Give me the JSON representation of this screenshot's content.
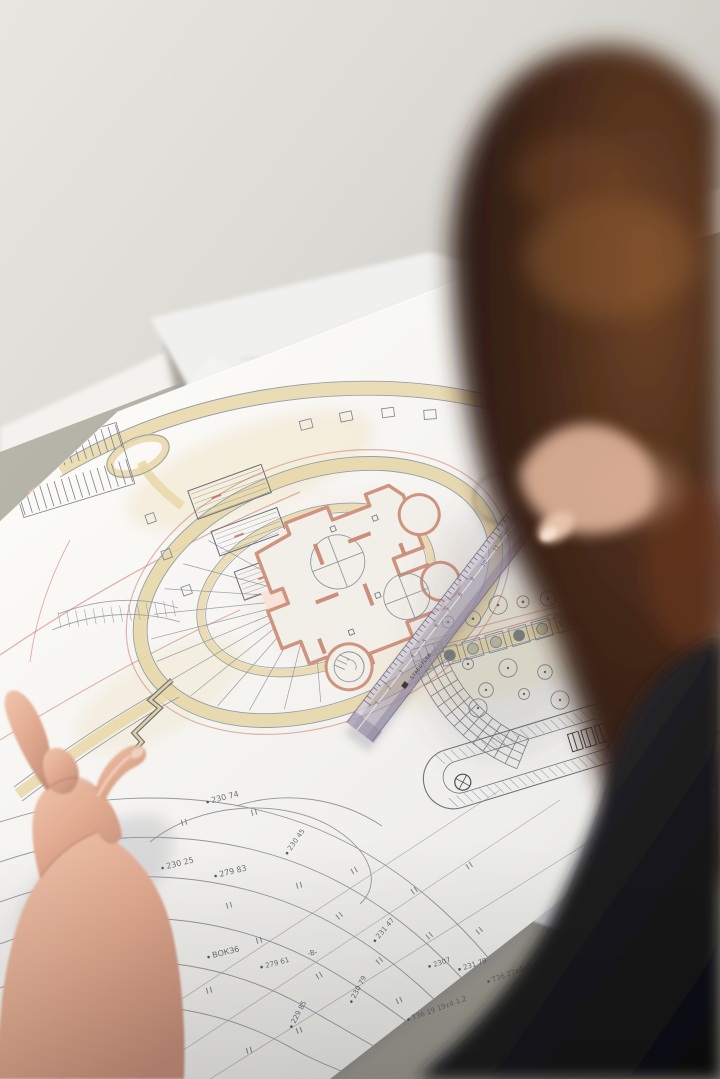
{
  "scene": {
    "description": "Over-the-shoulder photo of a person with curly auburn hair studying hand-drawn architectural master-plan and topographic sheets on a desk, left hand touching the plan, transparent ruler lying across the drawing",
    "ruler": {
      "brand": "STAEDTLER",
      "numbers": [
        "1",
        "2",
        "3",
        "4",
        "5",
        "6",
        "7",
        "8",
        "9",
        "10",
        "11",
        "12",
        "13",
        "14",
        "15",
        "16"
      ]
    },
    "plan": {
      "labels": [
        {
          "text": "230 74",
          "x": 212,
          "y": 803,
          "r": -14,
          "s": 8
        },
        {
          "text": "230 25",
          "x": 167,
          "y": 869,
          "r": -14,
          "s": 8
        },
        {
          "text": "279 83",
          "x": 220,
          "y": 877,
          "r": -14,
          "s": 8
        },
        {
          "text": "230 45",
          "x": 291,
          "y": 851,
          "r": -55,
          "s": 7
        },
        {
          "text": "ВОКЗ6",
          "x": 213,
          "y": 958,
          "r": -14,
          "s": 8
        },
        {
          "text": "229 85",
          "x": 295,
          "y": 1024,
          "r": -62,
          "s": 7
        },
        {
          "text": "230 79",
          "x": 355,
          "y": 999,
          "r": -62,
          "s": 7
        },
        {
          "text": "-В-",
          "x": 308,
          "y": 956,
          "r": -12,
          "s": 7
        },
        {
          "text": "279 61",
          "x": 266,
          "y": 968,
          "r": -15,
          "s": 7
        },
        {
          "text": "231 47",
          "x": 379,
          "y": 939,
          "r": -50,
          "s": 7
        },
        {
          "text": "2307",
          "x": 434,
          "y": 967,
          "r": -18,
          "s": 7
        },
        {
          "text": "231 79",
          "x": 464,
          "y": 970,
          "r": -18,
          "s": 7
        },
        {
          "text": "Т36 19 19х4 1.2",
          "x": 413,
          "y": 1020,
          "r": -20,
          "s": 7
        },
        {
          "text": "Т36 27х4х1.2",
          "x": 493,
          "y": 982,
          "r": -20,
          "s": 7
        },
        {
          "text": "233 43",
          "x": 595,
          "y": 855,
          "r": -55,
          "s": 7
        },
        {
          "text": "235 4",
          "x": 632,
          "y": 695,
          "r": -72,
          "s": 7
        },
        {
          "text": "МС РУП «Белгипрансвод»",
          "x": 647,
          "y": 762,
          "r": -21,
          "s": 6.5
        },
        {
          "text": "Лицей",
          "x": 613,
          "y": 790,
          "r": -17,
          "s": 9,
          "hand": true
        }
      ]
    },
    "colors": {
      "wall": "#e2e0db",
      "desk": "#b2afa5",
      "paper": "#f5f4f1",
      "sticky_note": "#f3cdc5",
      "road_tan": "#e7d7a8",
      "pencil_red": "#c47668",
      "graphite": "#80848e",
      "building_wall_pink": "#cf9480",
      "hair_dark": "#241510",
      "hair_highlight": "#8a5a33",
      "skin": "#e9bca4",
      "clothing": "#161618",
      "ruler_tint": "#aaa0b4"
    }
  }
}
